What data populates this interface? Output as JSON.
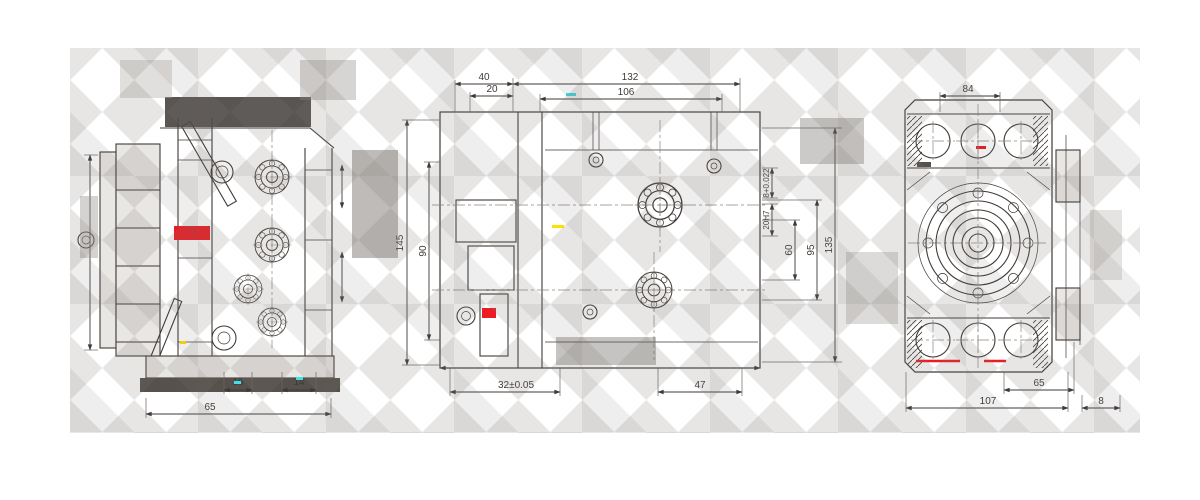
{
  "colors": {
    "line": "#3f3a37",
    "accent_red": "#ec1c24",
    "accent_yellow": "#ffe000",
    "accent_cyan": "#40e0e8"
  },
  "views": {
    "left": {
      "dims": {
        "d16": "16",
        "d14": "14",
        "d65": "65"
      }
    },
    "front": {
      "dims_top": {
        "d40": "40",
        "d20": "20",
        "d132": "132",
        "d106": "106"
      },
      "dims_left": {
        "d145": "145",
        "d90": "90"
      },
      "dims_bottom": {
        "d32": "32±0.05",
        "d47": "47"
      },
      "dims_right": {
        "d8t": "8+0.022",
        "d20h7": "20H7",
        "d60": "60",
        "d95": "95",
        "d135": "135"
      }
    },
    "right": {
      "dims": {
        "d84": "84",
        "d65": "65",
        "d107": "107",
        "d8": "8"
      }
    }
  }
}
